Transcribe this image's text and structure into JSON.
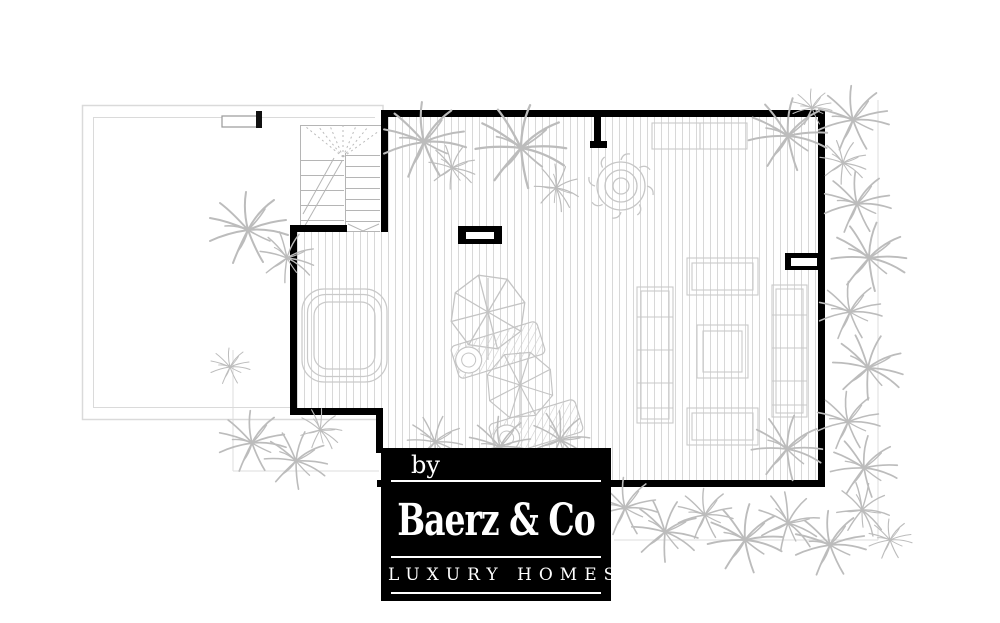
{
  "theme": {
    "background": "#ffffff",
    "wall": "#000000",
    "deck_line": "#d8d8d8",
    "sketch": "#c4c4c4",
    "plants": "#bcbcbc",
    "faint": "#e3e3e3",
    "logo_bg": "#000000",
    "logo_fg": "#ffffff"
  },
  "logo": {
    "prefix": "by",
    "name": "Baerz & Co",
    "tagline": "LUXURY HOMES"
  }
}
